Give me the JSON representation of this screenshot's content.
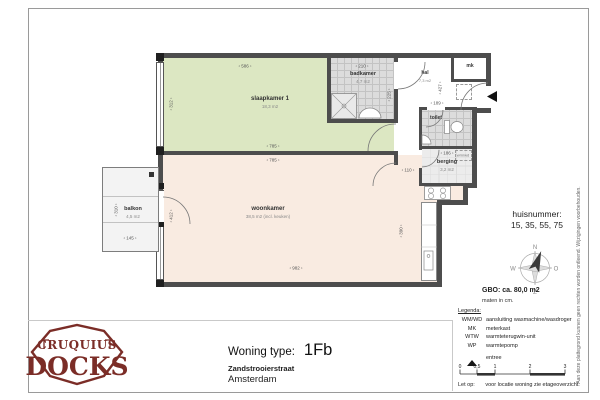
{
  "sheet": {
    "title_block": {
      "label": "Woning type:",
      "type": "1Fb",
      "street": "Zandstrooierstraat",
      "city": "Amsterdam"
    },
    "logo": {
      "top": "CRUQUIUS",
      "bottom": "DOCKS"
    },
    "info_panel": {
      "huisnummer_label": "huisnummer:",
      "huisnummer_values": "15, 35, 55, 75",
      "gbo": "GBO: ca. 80,0 m2",
      "maten": "maten in cm.",
      "compass": {
        "n": "N",
        "e": "O",
        "s": "Z",
        "w": "W"
      }
    },
    "legend": {
      "heading": "Legenda:",
      "items": [
        {
          "key": "WM/WD",
          "value": "aansluiting wasmachine/wasdroger"
        },
        {
          "key": "MK",
          "value": "meterkast"
        },
        {
          "key": "WTW",
          "value": "warmteterugwin-unit"
        },
        {
          "key": "WP",
          "value": "warmtepomp"
        }
      ],
      "entree_label": "entree",
      "scale_ticks": [
        "0",
        "0,5",
        "1",
        "2",
        "3"
      ],
      "note_label": "Let op:",
      "note_text": "voor locatie woning zie etageoverzicht."
    },
    "disclaimer": "Aan deze plattegrond kunnen geen rechten worden ontleend. Wijzigingen voorbehouden."
  },
  "plan": {
    "rooms": {
      "slaapkamer": {
        "name": "slaapkamer 1",
        "area": "18,3 m2"
      },
      "woonkamer": {
        "name": "woonkamer",
        "area": "38,5 m2 (incl. keuken)"
      },
      "badkamer": {
        "name": "badkamer",
        "area": "4,7 m2"
      },
      "hal": {
        "name": "hal",
        "area": "7,3 m2"
      },
      "mk": {
        "name": "mk"
      },
      "toilet": {
        "name": "toilet"
      },
      "berging": {
        "name": "berging",
        "area": "3,2 m2"
      },
      "balkon": {
        "name": "balkon",
        "area": "4,5 m2"
      },
      "wasmachine": {
        "name": "wm/wd"
      }
    },
    "dimensions": {
      "slaapkamer_breedte": "586",
      "slaapkamer_diepte": "312",
      "slaapkamer_breedte_onder": "785",
      "woonkamer_breedte_boven": "785",
      "woonkamer_diepte": "412",
      "woonkamer_breedte_onder": "982",
      "badkamer_breedte": "210",
      "badkamer_diepte": "225",
      "hal_diepte": "427",
      "hal_breedte": "189",
      "gang_breedte": "110",
      "berging_breedte": "186",
      "keuken_diepte": "390",
      "balkon_breedte": "145",
      "balkon_diepte": "310"
    }
  },
  "colors": {
    "slaapkamer_fill": "#dce7c2",
    "woonkamer_fill": "#f9ebe1",
    "tegel_fill": "#dcdcdc",
    "berging_fill": "#ececec",
    "muur": "#4d4d4d",
    "logo": "#7b2d27"
  }
}
